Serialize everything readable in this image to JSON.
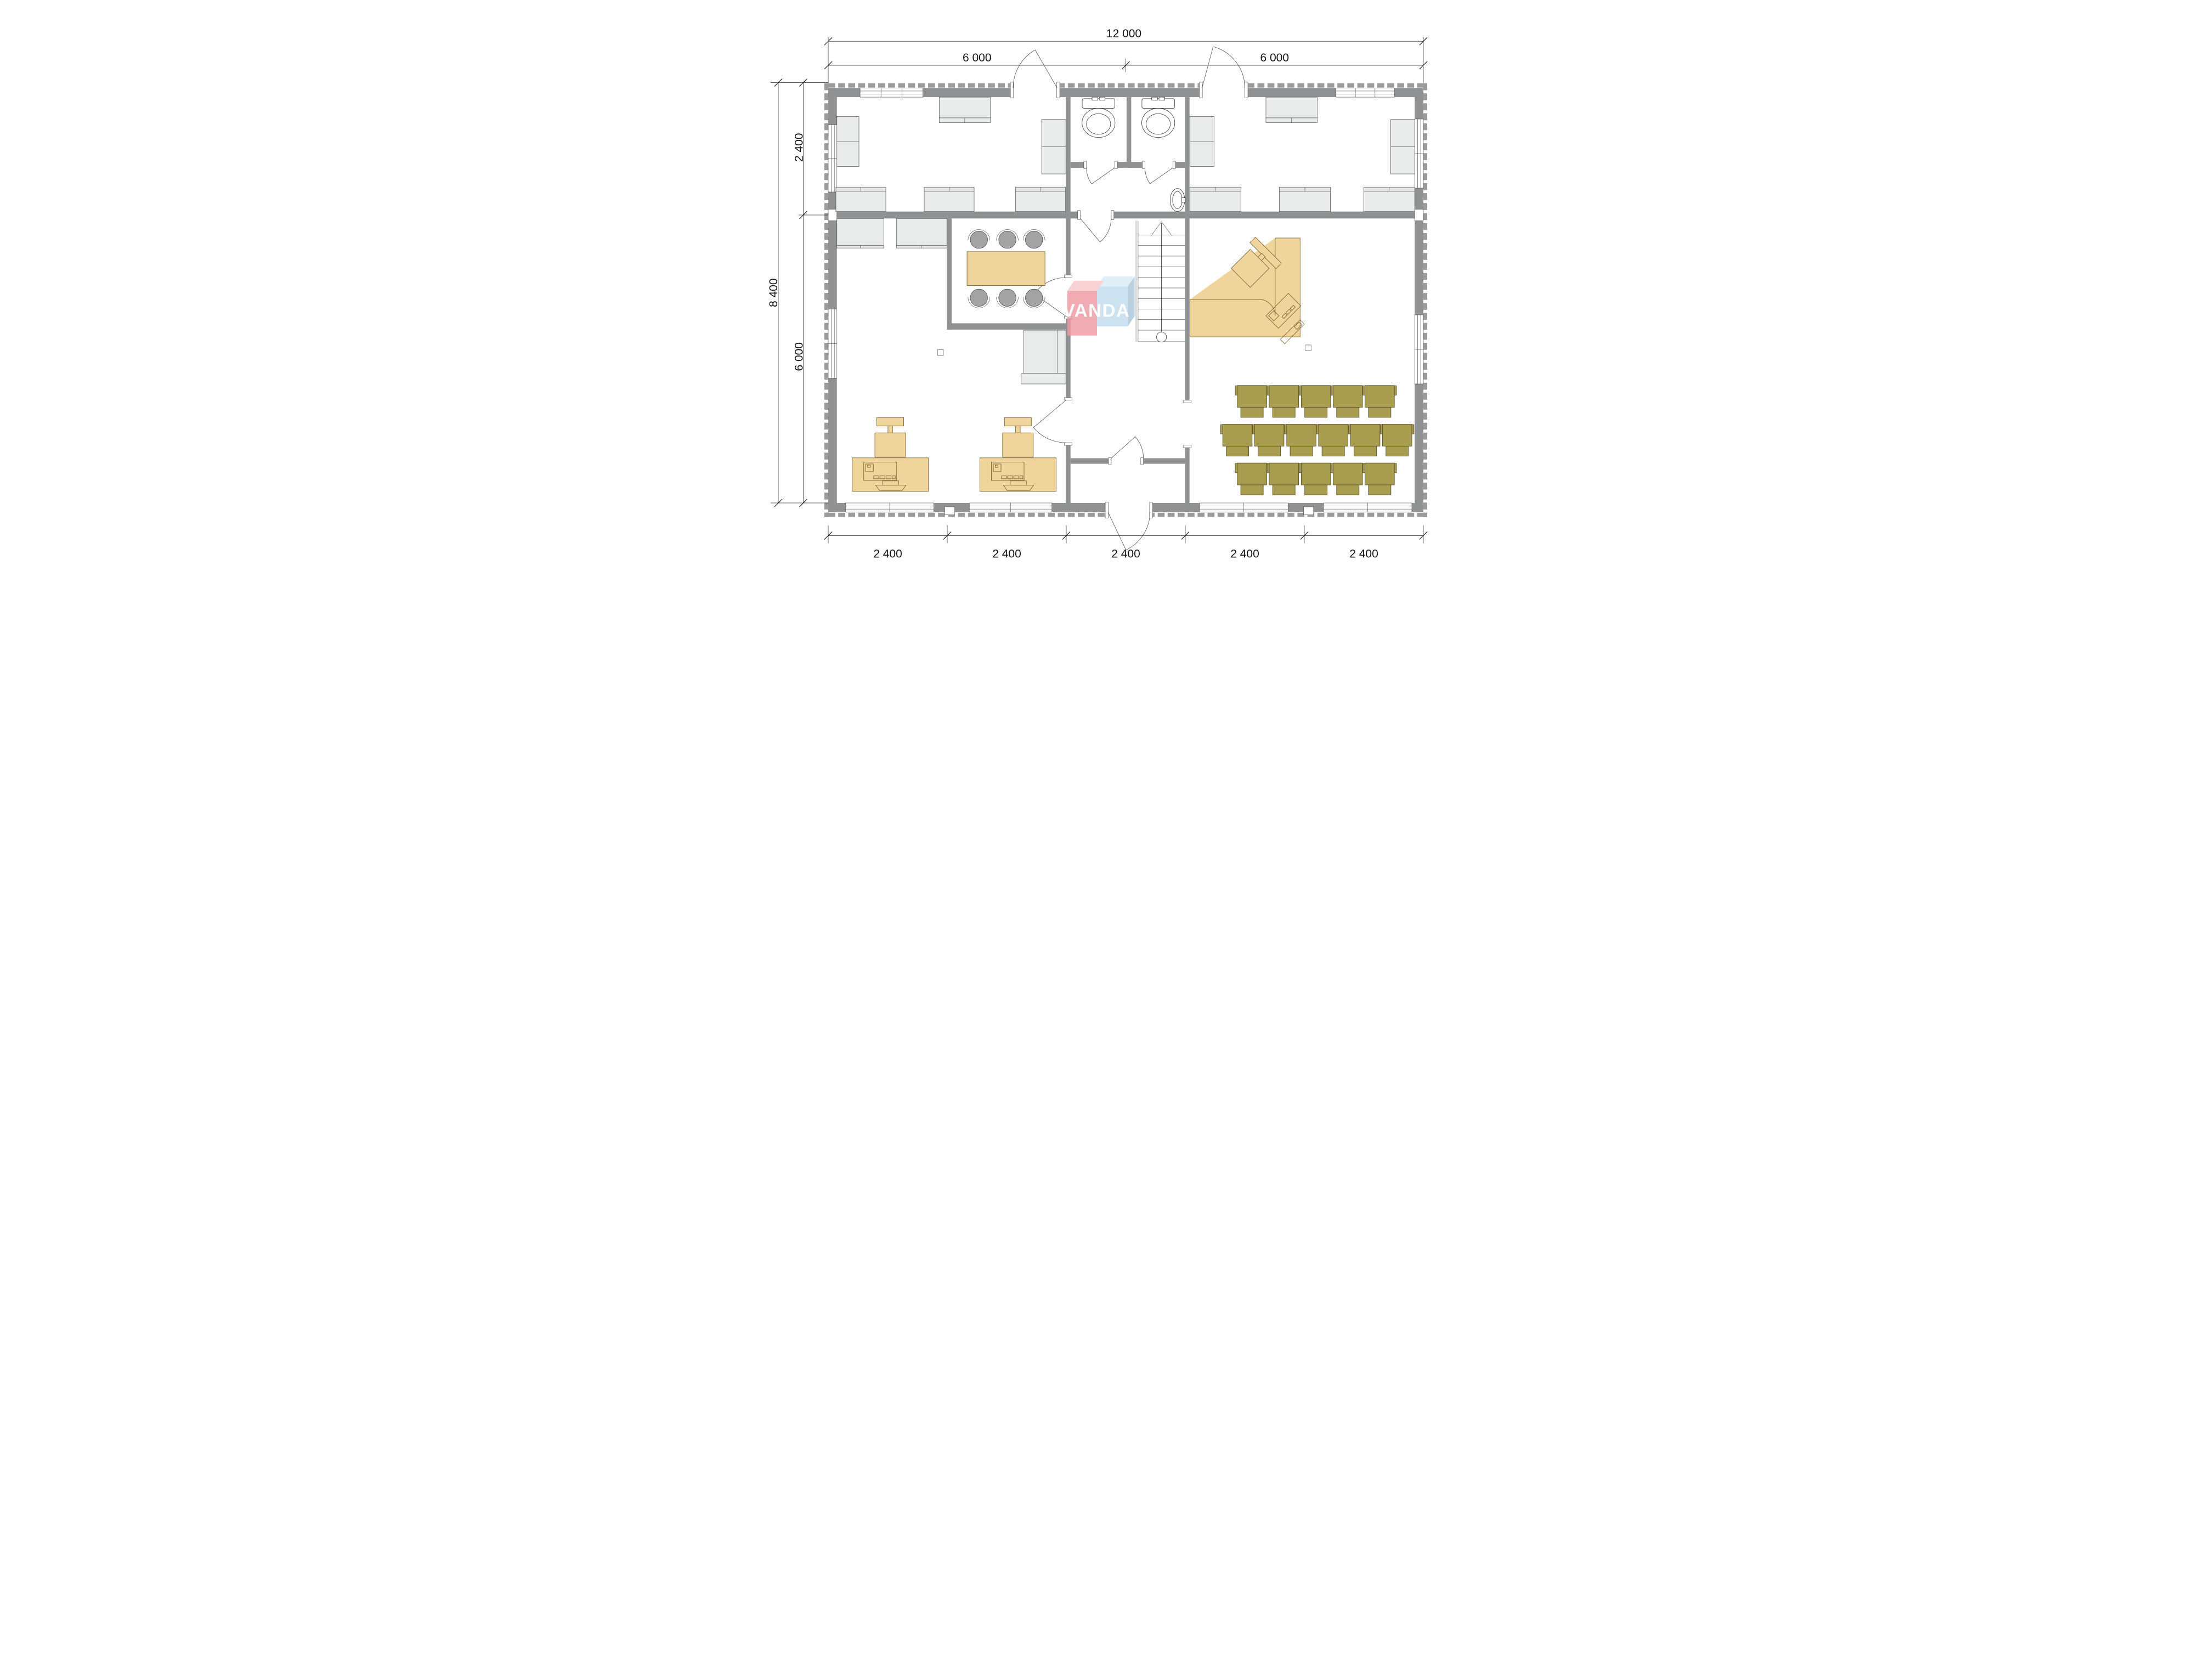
{
  "watermark": {
    "text": "VANDA"
  },
  "dimensions": {
    "top_total": "12 000",
    "top_spans": [
      "6 000",
      "6 000"
    ],
    "left_total": "8 400",
    "left_spans": [
      "2 400",
      "6 000"
    ],
    "bottom_spans": [
      "2 400",
      "2 400",
      "2 400",
      "2 400",
      "2 400"
    ]
  },
  "colors": {
    "wall": "#909193",
    "furn": "#e9eaea",
    "tan": "#efd49c",
    "tan_line": "#7b5f2a",
    "olive": "#a89d4f",
    "olive_line": "#56502c",
    "wm_pink": "#ef9aa3",
    "wm_pink_light": "#f7c9cd",
    "wm_blue": "#c3dcee",
    "wm_blue_light": "#d9ecf7",
    "wm_blue_dark": "#abc6d9",
    "ink": "#141414"
  }
}
